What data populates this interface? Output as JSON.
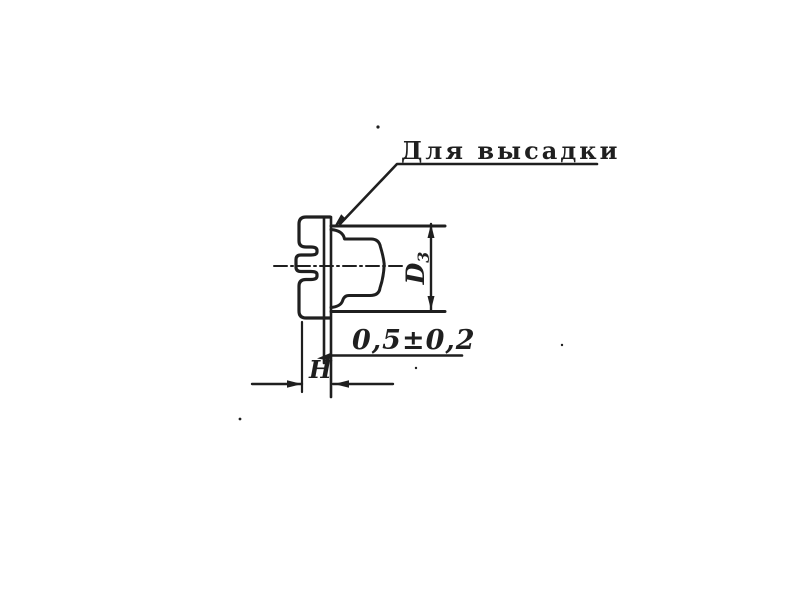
{
  "page": {
    "background": "#ffffff",
    "ink": "#1f1f1f",
    "description": "Scanned engineering drawing of a slotted-head tubular fastener blank (cross-section) with upsetting allowance"
  },
  "drawing": {
    "callout": {
      "label": "Для высадки"
    },
    "dimensions": {
      "diameter": {
        "base": "D",
        "subscript": "3"
      },
      "flange_thickness": {
        "value": "0,5±0,2"
      },
      "head_height": {
        "label": "H"
      }
    }
  }
}
